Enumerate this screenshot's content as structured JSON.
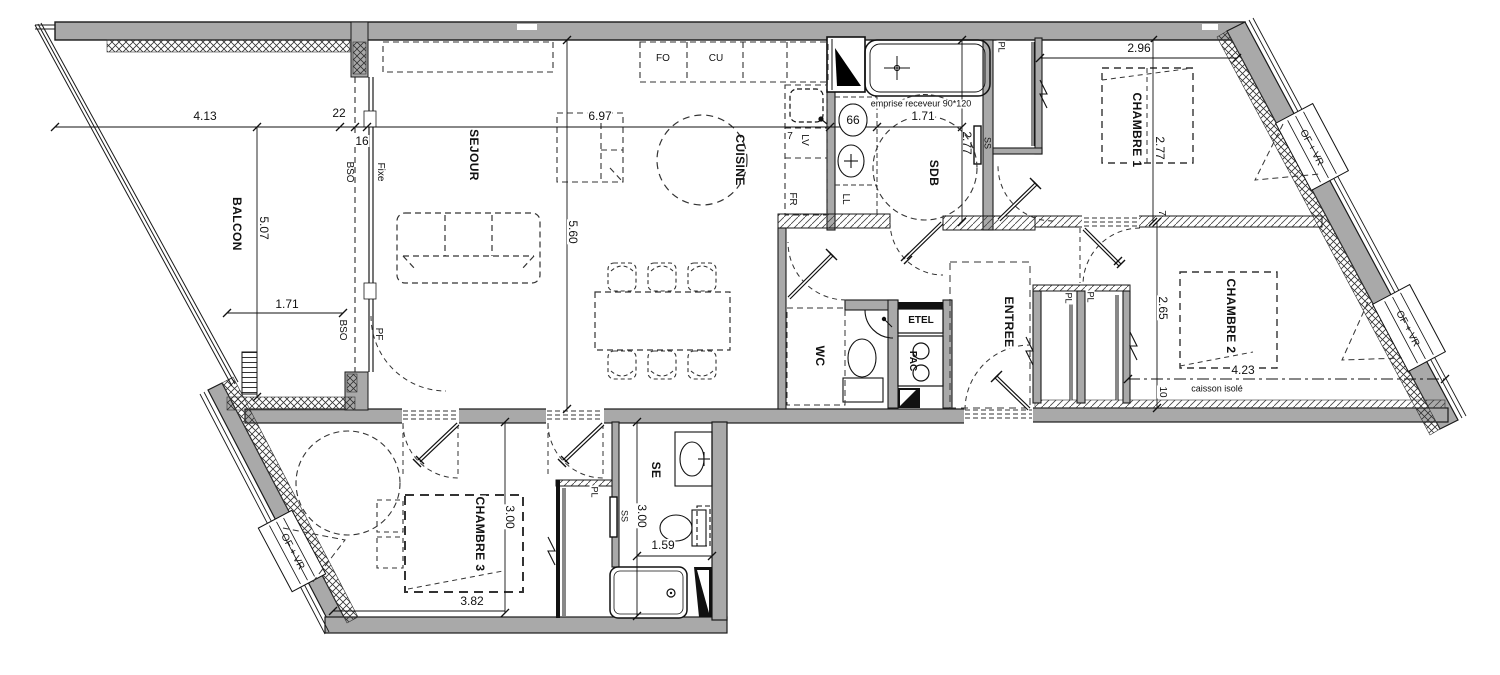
{
  "rooms": {
    "balcon": "BALCON",
    "sejour": "SEJOUR",
    "cuisine": "CUISINE",
    "sdb": "SDB",
    "chambre1": "CHAMBRE 1",
    "chambre2": "CHAMBRE 2",
    "chambre3": "CHAMBRE 3",
    "entree": "ENTREE",
    "wc": "WC",
    "se": "SE"
  },
  "dimensions": {
    "balcon_width": "4.13",
    "gap_22": "22",
    "gap_16": "16",
    "balcon_depth": "5.07",
    "balcon_len": "1.71",
    "sejour_width": "6.97",
    "sejour_depth": "5.60",
    "kitchen_7": "7",
    "vasque_66": "66",
    "sdb_width": "1.71",
    "sdb_depth": "2.77",
    "ch1_width": "2.96",
    "ch1_depth": "2.77",
    "wall_7": "7",
    "ch2_depth": "2.65",
    "ch2_width": "4.23",
    "caisson_10": "10",
    "ch3_depth": "3.00",
    "ch3_width": "3.82",
    "se_depth": "3.00",
    "se_width": "1.59"
  },
  "annotations": {
    "emprise": "emprise receveur 90*120",
    "caisson": "caisson isolé",
    "fo": "FO",
    "cu": "CU",
    "lv": "LV",
    "fr": "FR",
    "ll": "LL",
    "ss_sdb": "SS",
    "ss_se": "SS",
    "pl_ch1": "PL",
    "pl_ch2_left": "PL",
    "pl_ch2_right": "PL",
    "pl_ch3": "PL",
    "bso_top": "BSO",
    "bso_bottom": "BSO",
    "fixe": "Fixe",
    "pf": "PF",
    "etel": "ETEL",
    "pac": "PAC",
    "ofvr_right_top": "OF + VR",
    "ofvr_right_bottom": "OF + VR",
    "ofvr_left": "OF + VR"
  },
  "colors": {
    "wall_fill": "#a9a9a9",
    "outline": "#1a1a1a",
    "hatch": "#333333"
  }
}
